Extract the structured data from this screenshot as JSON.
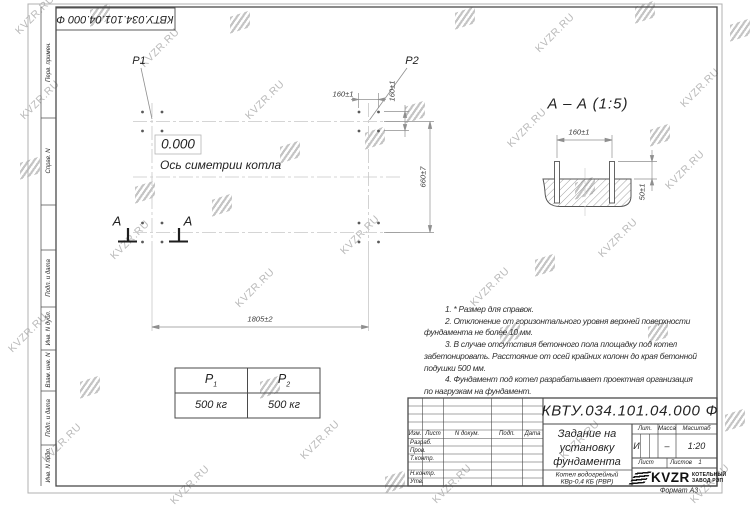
{
  "watermark": {
    "text": "KVZR.RU"
  },
  "stamp_reversed": "КВТУ.034.101.04.000 Ф",
  "side_labels": [
    "Перв. примен.",
    "Справ. N",
    "Подп. и дата",
    "Инв. N дубл.",
    "Взам. инв. N",
    "Подп. и дата",
    "Инв. N подл."
  ],
  "plan": {
    "p1": "P1",
    "p2": "P2",
    "level_mark": "0.000",
    "axis_label": "Ось симетрии котла",
    "dim_160_h": "160±1",
    "dim_160_v": "160±1",
    "dim_660": "660±7",
    "dim_1805": "1805±2",
    "section_letter": "A"
  },
  "section": {
    "title": "A – A (1:5)",
    "dim_160": "160±1",
    "dim_50": "50±1"
  },
  "notes": [
    "1. * Размер для справок.",
    "2. Отклонение от горизонтального уровня верхней поверхности",
    "фундамента не более 10 мм.",
    "3. В случае отсутствия бетонного пола площадку под котел",
    "забетонировать. Расстояние от осей крайних колонн до края бетонной",
    "подушки 500 мм.",
    "4. Фундамент под котел разрабатывает проектная организация",
    "по нагрузкам на фундамент."
  ],
  "load_table": {
    "h1_base": "P",
    "h1_sub": "1",
    "h2_base": "P",
    "h2_sub": "2",
    "v1": "500 кг",
    "v2": "500 кг"
  },
  "title_block": {
    "designation": "КВТУ.034.101.04.000  Ф",
    "doc_title_lines": [
      "Задание на",
      "установку",
      "фундамента"
    ],
    "product_lines": [
      "Котел водогрейный",
      "КВр-0,4  КБ  (РВР)"
    ],
    "header_cols": [
      "Изм.",
      "Лист",
      "N докум.",
      "Подп.",
      "Дата"
    ],
    "sign_rows": [
      "Разраб.",
      "Пров.",
      "Т.контр.",
      "Н.контр.",
      "Утв."
    ],
    "lit_label": "Лит.",
    "mass_label": "Масса",
    "scale_label": "Масштаб",
    "lit_value": "И",
    "mass_value": "–",
    "scale_value": "1:20",
    "sheet_label": "Лист",
    "sheets_label": "Листов",
    "sheets_value": "1",
    "logo_text": "KVZR",
    "logo_sub1": "КОТЕЛЬНЫЙ",
    "logo_sub2": "ЗАВОД РЭП",
    "format_label": "Формат А3"
  }
}
